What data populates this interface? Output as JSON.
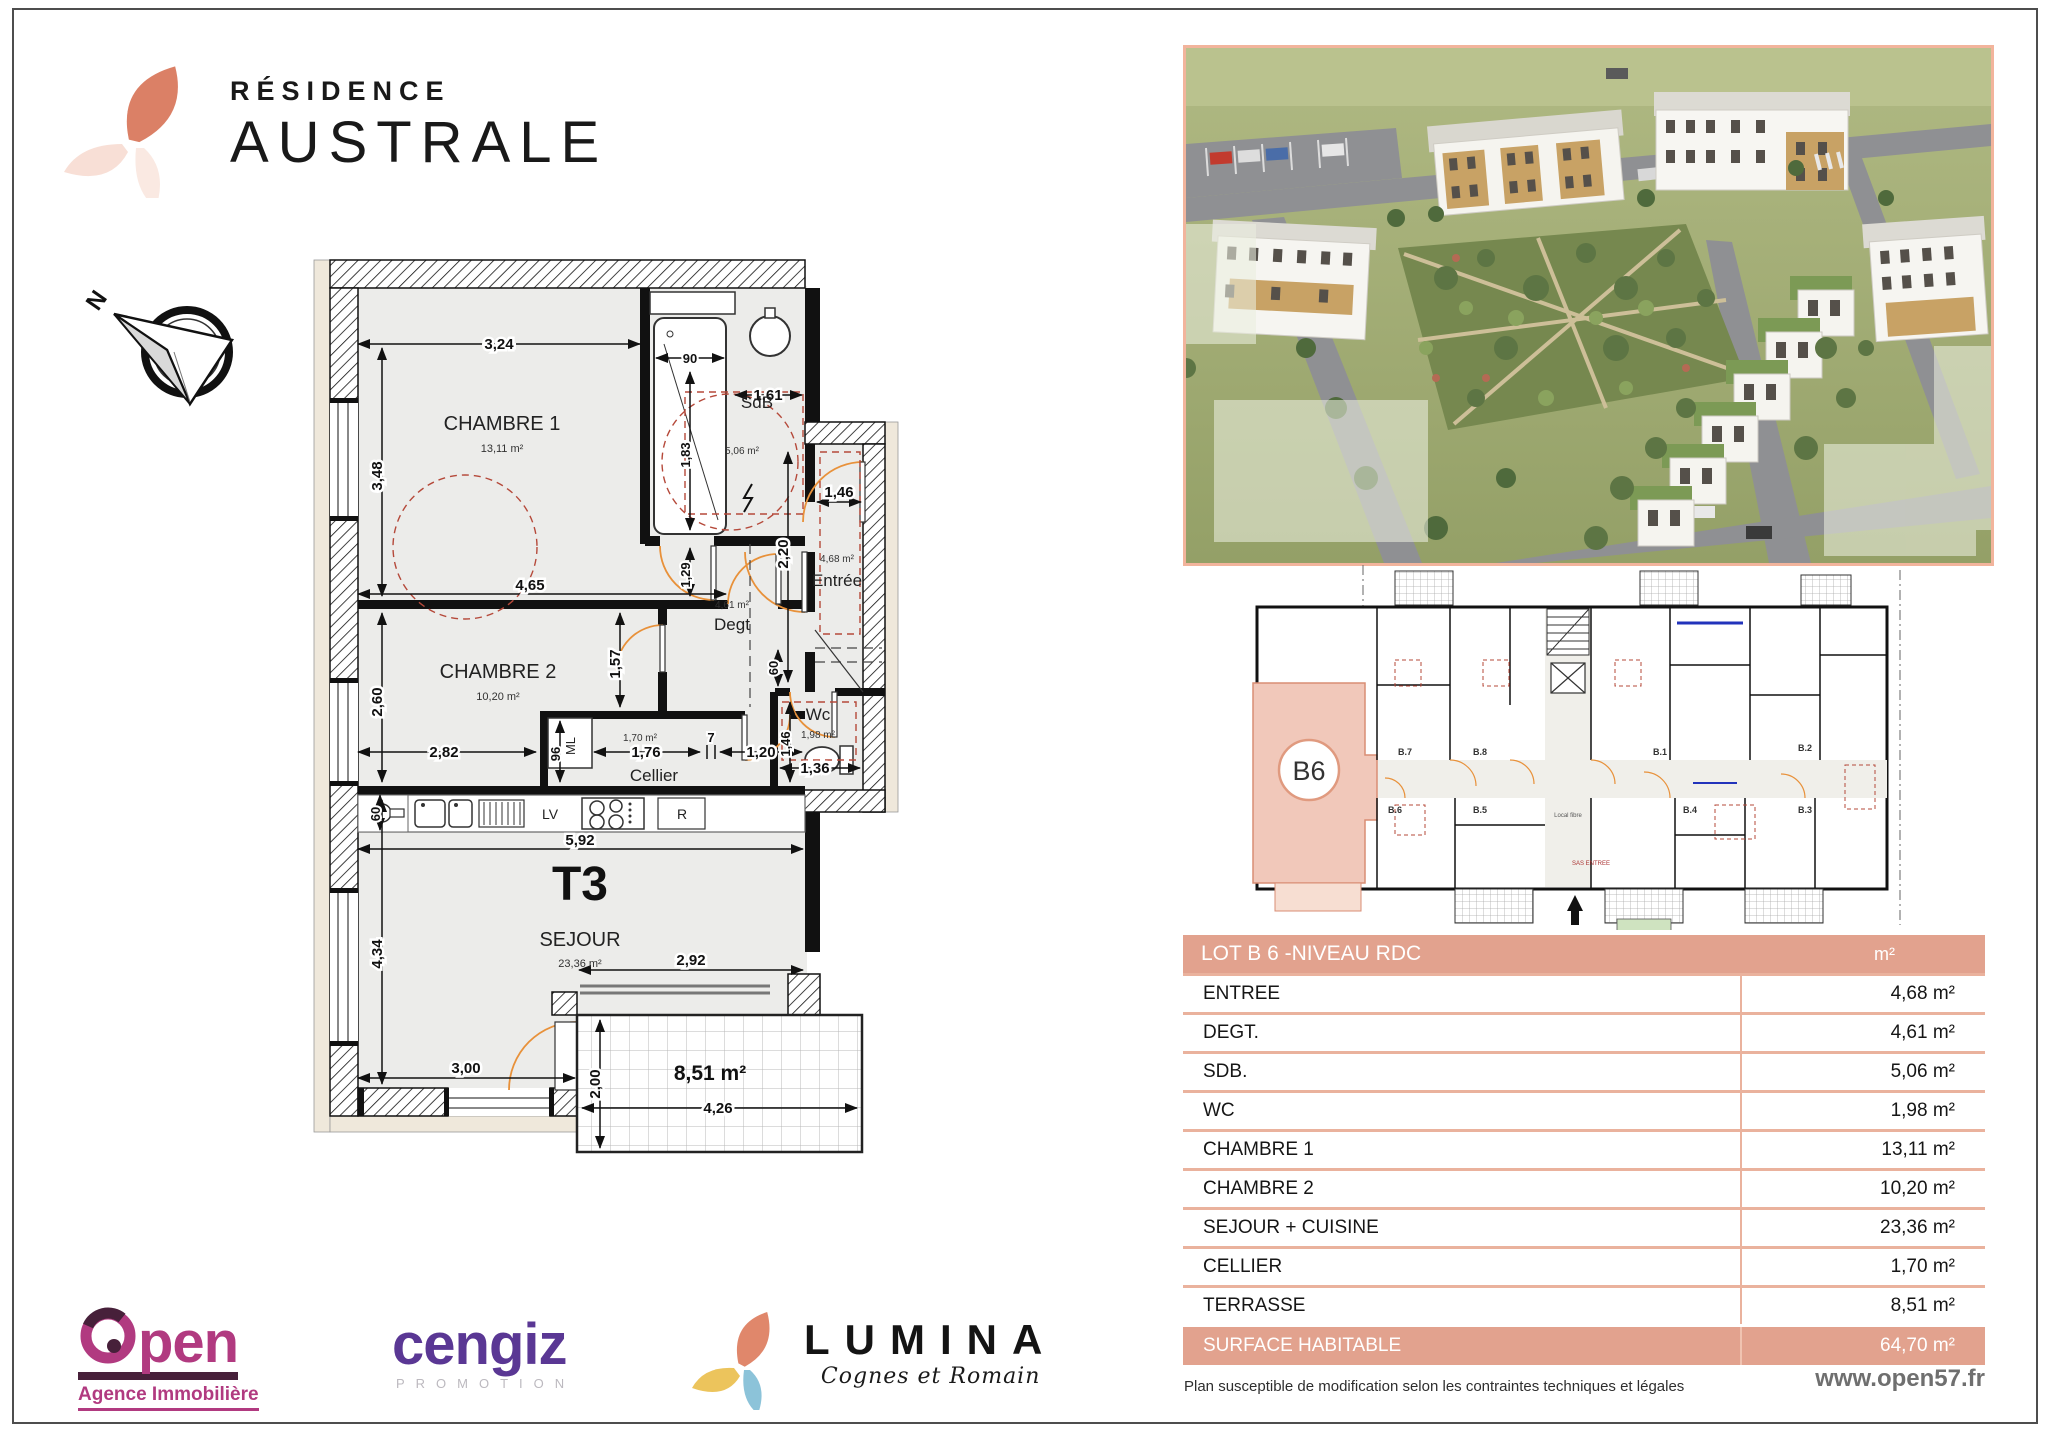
{
  "page": {
    "brand": {
      "line1": "RÉSIDENCE",
      "line2": "AUSTRALE"
    },
    "compass_n": "N",
    "footer": {
      "disclaimer": "Plan susceptible de modification selon les contraintes techniques et légales",
      "website": "www.open57.fr"
    }
  },
  "plan": {
    "type_label": "T3",
    "rooms": {
      "chambre1": {
        "name": "CHAMBRE 1",
        "area": "13,11 m²"
      },
      "chambre2": {
        "name": "CHAMBRE 2",
        "area": "10,20 m²"
      },
      "sdb": {
        "name": "SdB",
        "area": "5,06 m²"
      },
      "entree": {
        "name": "Entrée",
        "area": "4,68 m²"
      },
      "degt": {
        "name": "Degt",
        "area": "4,61 m²"
      },
      "wc": {
        "name": "Wc",
        "area": "1,98 m²"
      },
      "cellier": {
        "name": "Cellier",
        "area": "1,70 m²"
      },
      "sejour": {
        "name": "SEJOUR",
        "area": "23,36 m²"
      },
      "terrasse": {
        "area": "8,51 m²"
      }
    },
    "appliances": {
      "lv": "LV",
      "r": "R",
      "ml": "ML"
    },
    "dims": {
      "ch1_w": "3,24",
      "ch1_h": "3,48",
      "shower_w": "90",
      "shower_h": "1,83",
      "sdb_w": "1,61",
      "sdb_gap": "1,29",
      "mid_w": "4,65",
      "corr_h": "1,57",
      "ch2_h": "2,60",
      "ch2_w": "2,82",
      "ml_h": "96",
      "cellier_w": "1,76",
      "small7": "7",
      "w120": "1,20",
      "entree_h": "2,20",
      "entree_w": "1,46",
      "h60": "60",
      "wc_h": "1,46",
      "wc_w": "1,36",
      "kitchen_w": "5,92",
      "kitchen_d": "60",
      "sejour_h": "4,34",
      "sejour_rw": "2,92",
      "sejour_bw": "3,00",
      "terr_h": "2,00",
      "terr_w": "4,26"
    }
  },
  "masse": {
    "unit": "B6",
    "labels": [
      "B.7",
      "B.8",
      "B.1",
      "B.2",
      "B.6",
      "B.5",
      "B.4",
      "B.3"
    ],
    "local_fibre": "Local fibre",
    "sas": "SAS ENTREE"
  },
  "table": {
    "header": {
      "title": "LOT B 6 -NIVEAU RDC",
      "unit": "m²"
    },
    "rows": [
      {
        "label": "ENTREE",
        "value": "4,68 m²"
      },
      {
        "label": "DEGT.",
        "value": "4,61 m²"
      },
      {
        "label": "SDB.",
        "value": "5,06 m²"
      },
      {
        "label": "WC",
        "value": "1,98 m²"
      },
      {
        "label": "CHAMBRE 1",
        "value": "13,11 m²"
      },
      {
        "label": "CHAMBRE 2",
        "value": "10,20 m²"
      },
      {
        "label": "SEJOUR + CUISINE",
        "value": "23,36 m²"
      },
      {
        "label": "CELLIER",
        "value": "1,70 m²"
      },
      {
        "label": "TERRASSE",
        "value": "8,51 m²"
      }
    ],
    "total": {
      "label": "SURFACE HABITABLE",
      "value": "64,70 m²"
    }
  },
  "partners": {
    "open": {
      "name_rest": "pen",
      "subtitle": "Agence Immobilière"
    },
    "cengiz": {
      "name": "cengiz",
      "subtitle": "PROMOTION"
    },
    "lumina": {
      "name": "LUMINA",
      "subtitle": "Cognes et Romain"
    }
  },
  "colors": {
    "accent": "#E2A28E",
    "accent_light": "#F2CBBD",
    "table_line": "#EAB29D",
    "petal_coral": "#DB8066",
    "open_magenta": "#B13A80",
    "cengiz_purple": "#5A3794",
    "lumina_coral": "#E0876B",
    "lumina_yellow": "#ECC45C",
    "lumina_blue": "#8CC3D9",
    "door_arc_orange": "#E8913A",
    "accessibility_red": "#B5493A"
  }
}
